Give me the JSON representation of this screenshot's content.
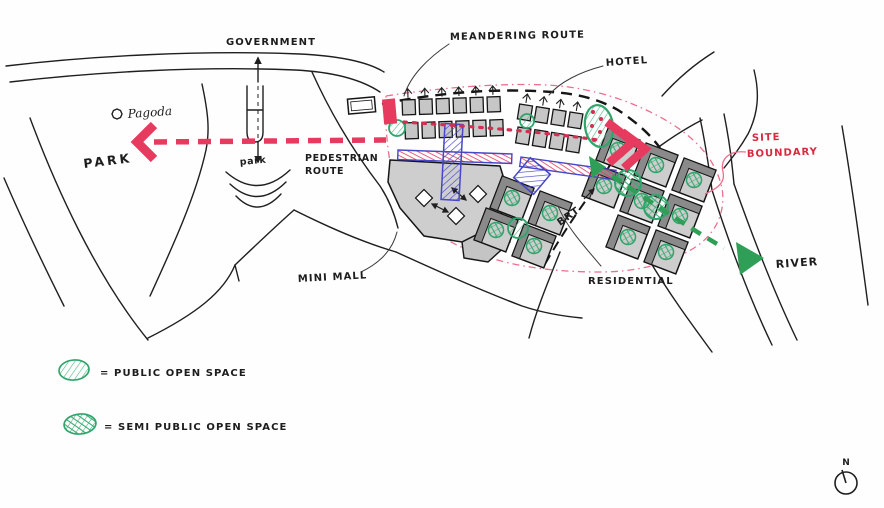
{
  "title": "Urban design concept sketch",
  "labels": {
    "government": "GOVERNMENT",
    "meandering_route": "MEANDERING ROUTE",
    "hotel": "HOTEL",
    "pagoda": "Pagoda",
    "park": "PARK",
    "park_small": "park",
    "pedestrian_route": {
      "line1": "PEDESTRIAN",
      "line2": "ROUTE"
    },
    "mini_mall": "MINI MALL",
    "brt": "BRT",
    "residential": "RESIDENTIAL",
    "site_boundary": {
      "line1": "SITE",
      "line2": "BOUNDARY"
    },
    "river": "RIVER"
  },
  "legend": {
    "items": [
      {
        "symbol": "public-open-space-swatch",
        "label": "= PUBLIC OPEN SPACE"
      },
      {
        "symbol": "semi-public-open-space-swatch",
        "label": "= SEMI PUBLIC OPEN SPACE"
      }
    ]
  },
  "compass": {
    "label": "N"
  },
  "colors": {
    "route_red": "#e63a5e",
    "route_red_dots": "#d22f52",
    "site_boundary_pink": "#ec6f8e",
    "site_boundary_text_red": "#d9293f",
    "open_space_green": "#2fa56b",
    "route_green": "#2f9e57",
    "transit_blue": "#4646c8",
    "building_gray": "#cdcdcd",
    "building_shadow_gray": "#8a8a8a",
    "ink_black": "#1f1f1f",
    "paper_white": "#fefefe"
  }
}
